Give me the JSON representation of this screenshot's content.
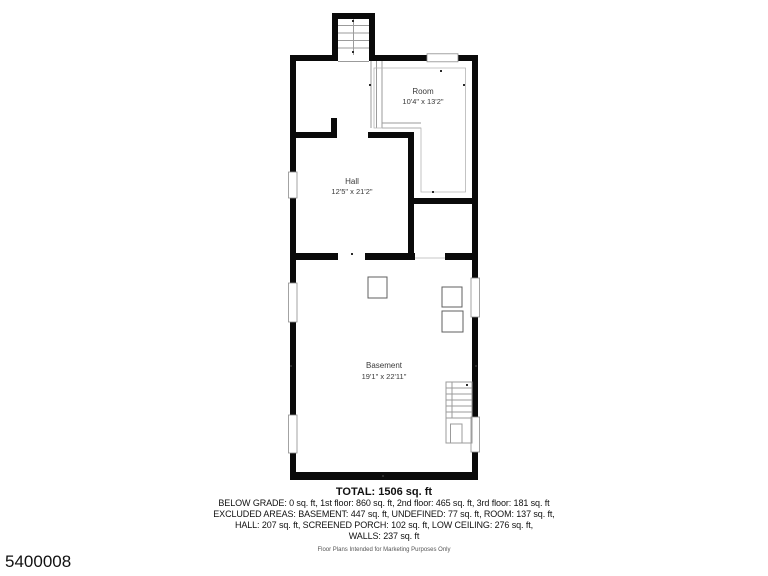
{
  "page": {
    "background_color": "#ffffff",
    "wall_color": "#0a0a0a",
    "thin_line_color": "#9b9b9b"
  },
  "watermark": "5400008",
  "floor_plan": {
    "rooms": [
      {
        "name": "Room",
        "dimensions": "10'4\" x 13'2\""
      },
      {
        "name": "Hall",
        "dimensions": "12'5\" x 21'2\""
      },
      {
        "name": "Basement",
        "dimensions": "19'1\" x 22'11\""
      }
    ]
  },
  "summary": {
    "total": "TOTAL: 1506 sq. ft",
    "lines": [
      "BELOW GRADE: 0 sq. ft, 1st floor: 860 sq. ft, 2nd floor: 465 sq. ft, 3rd floor: 181 sq. ft",
      "EXCLUDED AREAS: BASEMENT: 447 sq. ft, UNDEFINED: 77 sq. ft, ROOM: 137 sq. ft,",
      "HALL: 207 sq. ft, SCREENED PORCH: 102 sq. ft, LOW CEILING: 276 sq. ft,",
      "WALLS: 237 sq. ft"
    ],
    "disclaimer": "Floor Plans Intended for Marketing Purposes Only"
  }
}
